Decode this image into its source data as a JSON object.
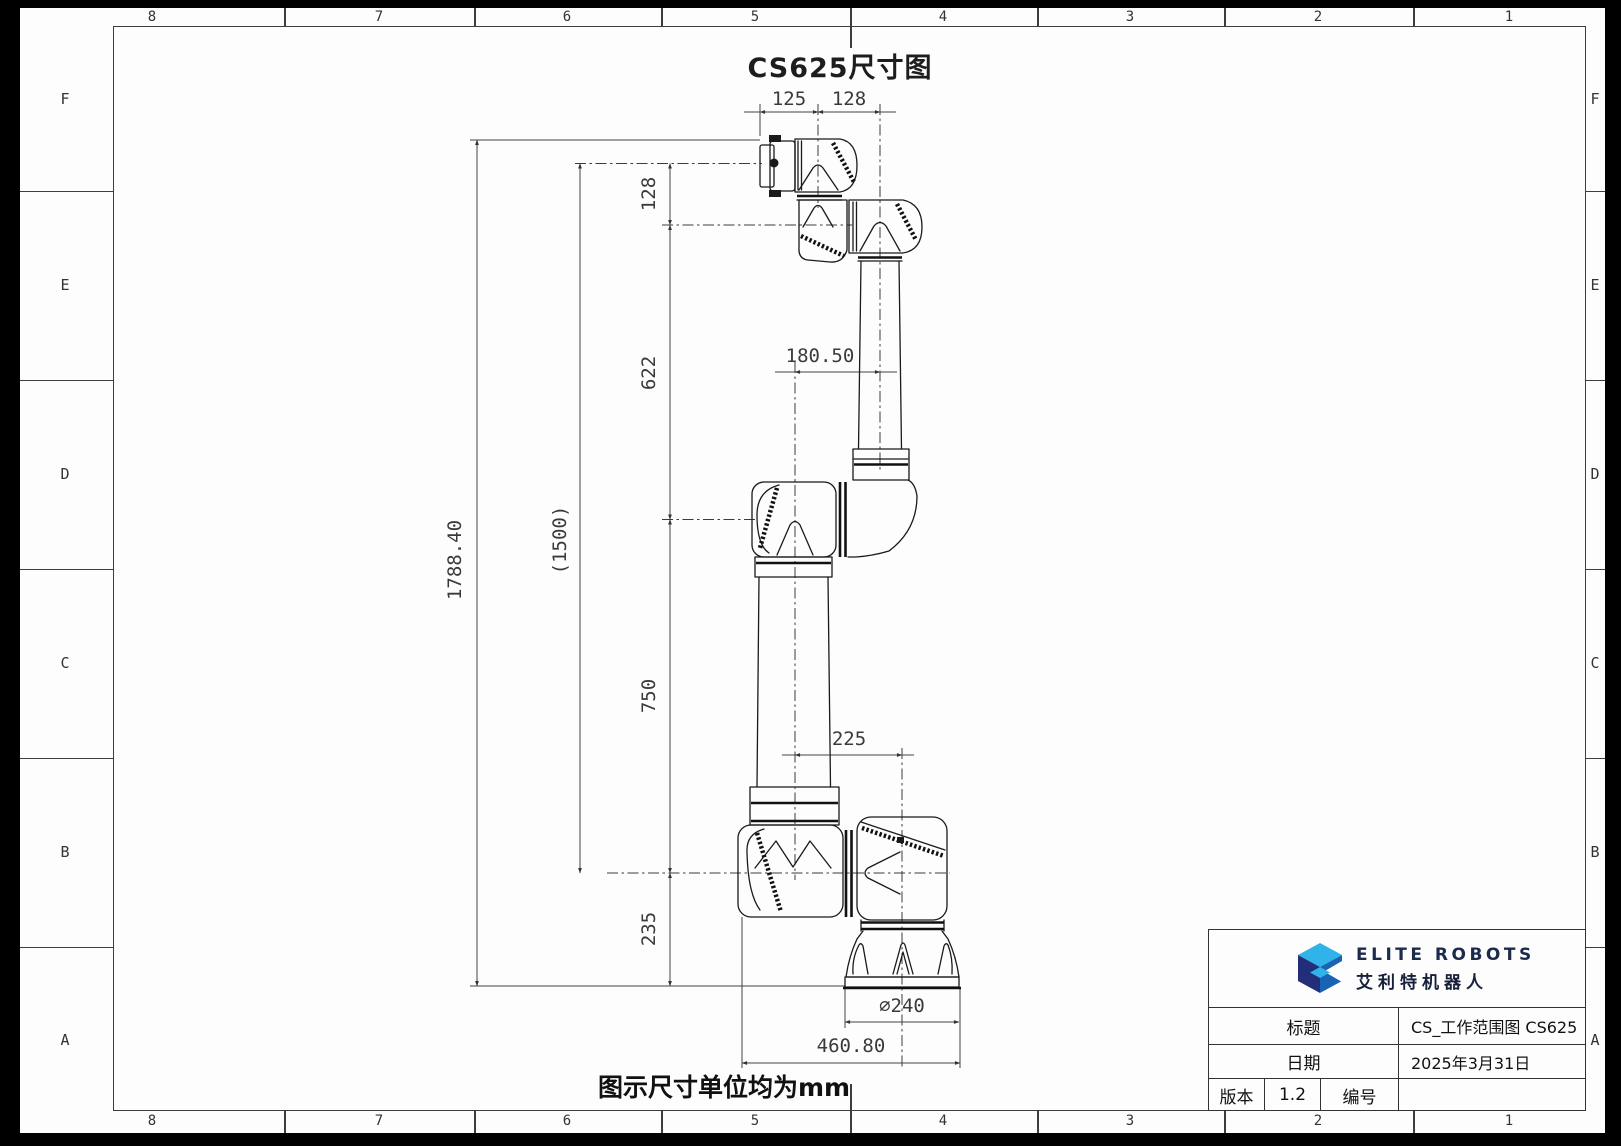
{
  "sheet": {
    "title": "CS625尺寸图",
    "note": "图示尺寸单位均为mm",
    "zone_columns": [
      "8",
      "7",
      "6",
      "5",
      "4",
      "3",
      "2",
      "1"
    ],
    "zone_rows": [
      "F",
      "E",
      "D",
      "C",
      "B",
      "A"
    ]
  },
  "dims": {
    "d125": "125",
    "d128h": "128",
    "d128v": "128",
    "d622": "622",
    "d750": "750",
    "d235": "235",
    "d1788": "1788.40",
    "d1500": "(1500)",
    "d180": "180.50",
    "d225": "225",
    "d240": "∅240",
    "d460": "460.80"
  },
  "title_block": {
    "brand_en": "ELITE ROBOTS",
    "brand_cn": "艾利特机器人",
    "title_label": "标题",
    "title_value": "CS_工作范围图 CS625",
    "date_label": "日期",
    "date_value": "2025年3月31日",
    "version_label": "版本",
    "version_value": "1.2",
    "number_label": "编号",
    "number_value": ""
  },
  "colors": {
    "paper": "#fdfdfd",
    "line": "#1a1a1a",
    "logo_dark": "#232e7a",
    "logo_mid": "#1a63b4",
    "logo_light": "#2fb3e8",
    "brand_text": "#1c2b4a"
  }
}
